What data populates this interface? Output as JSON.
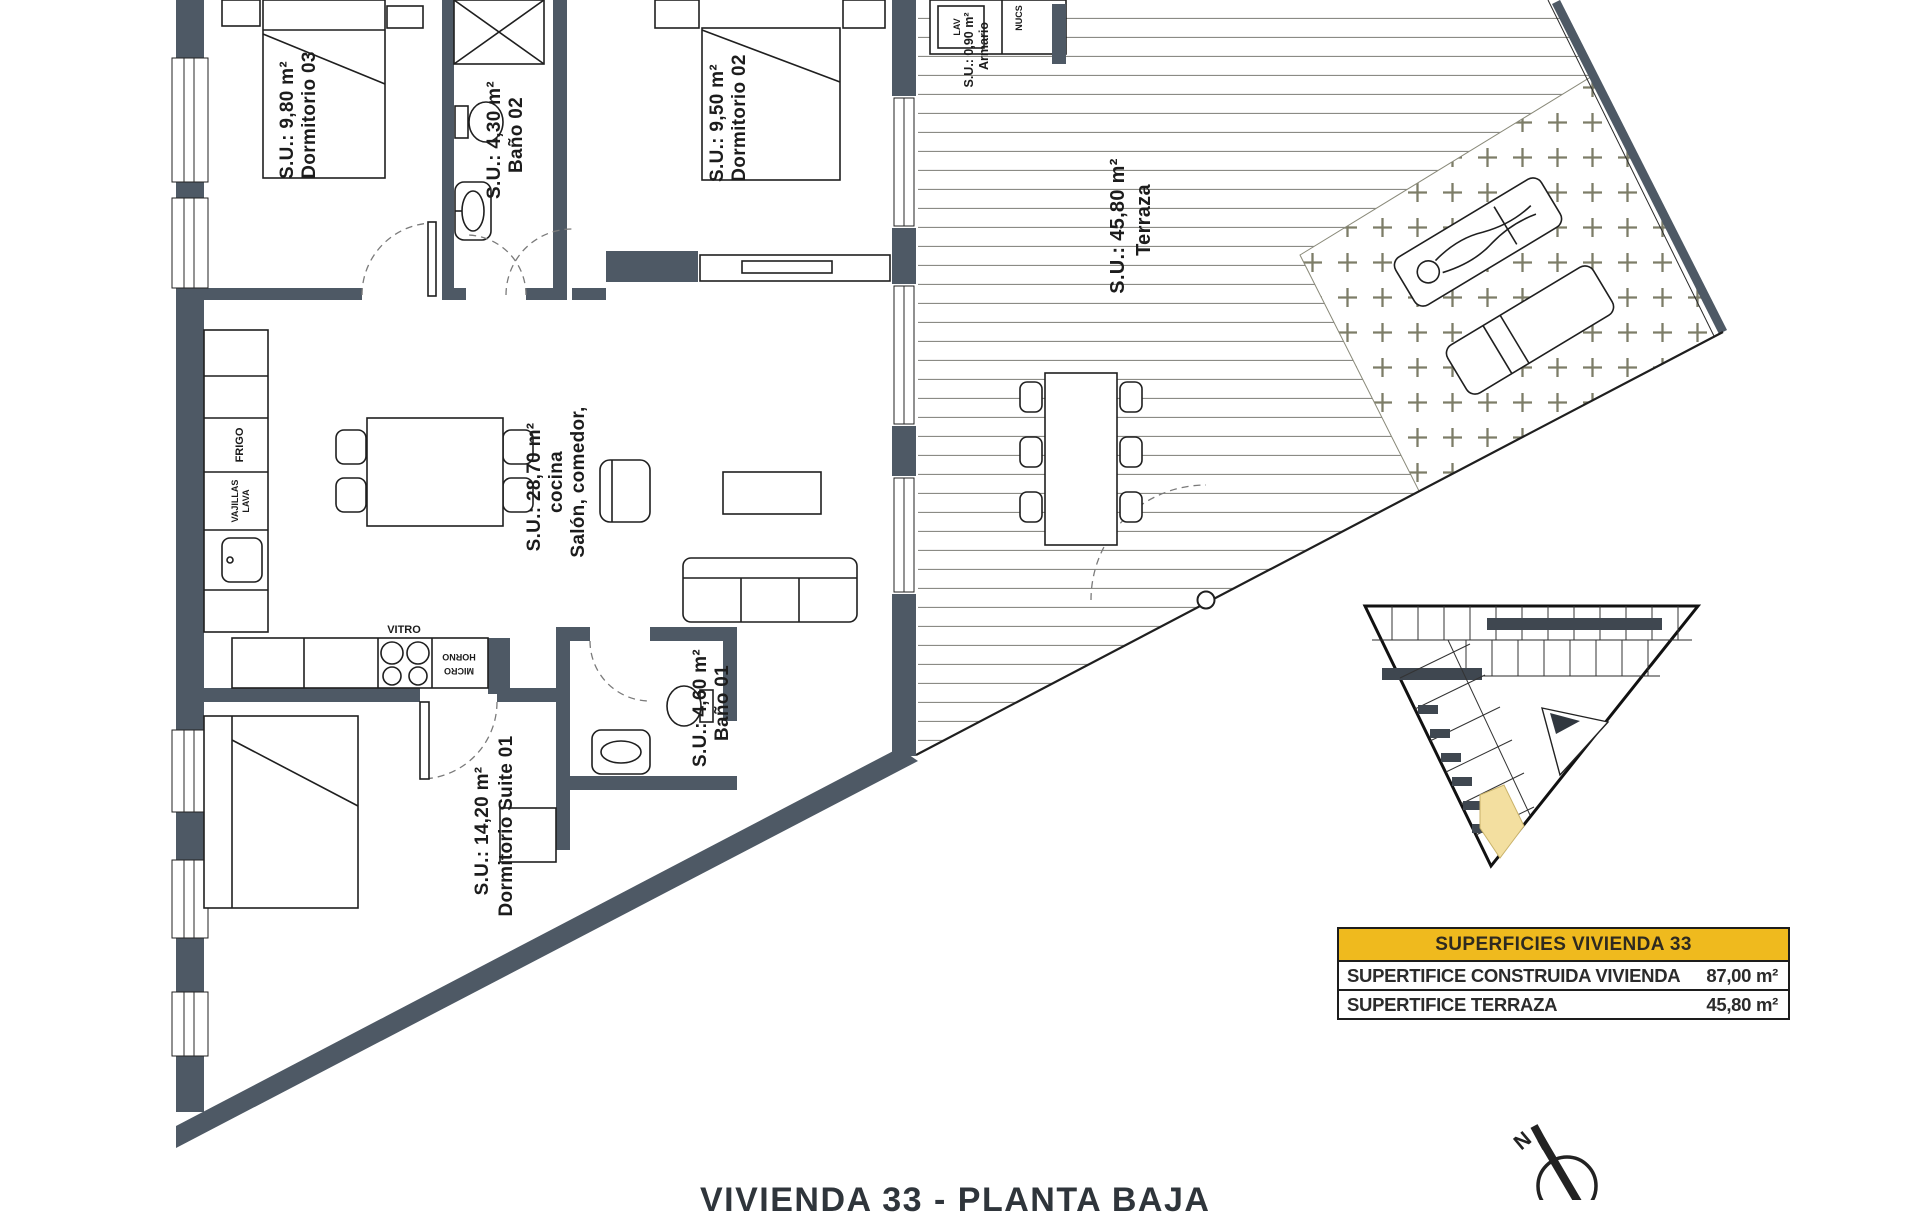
{
  "page": {
    "title": "VIVIENDA 33 - PLANTA BAJA"
  },
  "colors": {
    "wall": "#4e5965",
    "deck_line": "#8b8b85",
    "plus_marker": "#7d7d68",
    "table_header_bg": "#efba1e",
    "site_plan_highlight": "#f3dfa0",
    "drawing_line": "#1f1f1f"
  },
  "rooms": {
    "dormitorio03": {
      "name": "Dormitorio 03",
      "area": "S.U.: 9,80 m²"
    },
    "bano02": {
      "name": "Baño 02",
      "area": "S.U.: 4,30 m²"
    },
    "dormitorio02": {
      "name": "Dormitorio 02",
      "area": "S.U.: 9,50 m²"
    },
    "armario": {
      "name": "Armario",
      "area": "S.U.: 0,90 m²"
    },
    "terraza": {
      "name": "Terraza",
      "area": "S.U.: 45,80 m²"
    },
    "salon": {
      "name_line1": "Salón, comedor,",
      "name_line2": "cocina",
      "area": "S.U.: 28,70 m²"
    },
    "bano01": {
      "name": "Baño 01",
      "area": "S.U.: 4,60 m²"
    },
    "suite01": {
      "name": "Dormitorio Suite 01",
      "area": "S.U.: 14,20 m²"
    }
  },
  "fixtures": {
    "frigo": "FRIGO",
    "lava_line1": "LAVA",
    "lava_line2": "VAJILLAS",
    "vitro": "VITRO",
    "horno_line1": "HORNO",
    "horno_line2": "MICRO",
    "lav": "LAV",
    "nucs": "NUCS"
  },
  "summary_table": {
    "header": "SUPERFICIES VIVIENDA 33",
    "rows": [
      {
        "label": "SUPERTIFICE CONSTRUIDA VIVIENDA",
        "value": "87,00 m²"
      },
      {
        "label": "SUPERTIFICE TERRAZA",
        "value": "45,80 m²"
      }
    ]
  },
  "compass": {
    "north_label": "N"
  }
}
